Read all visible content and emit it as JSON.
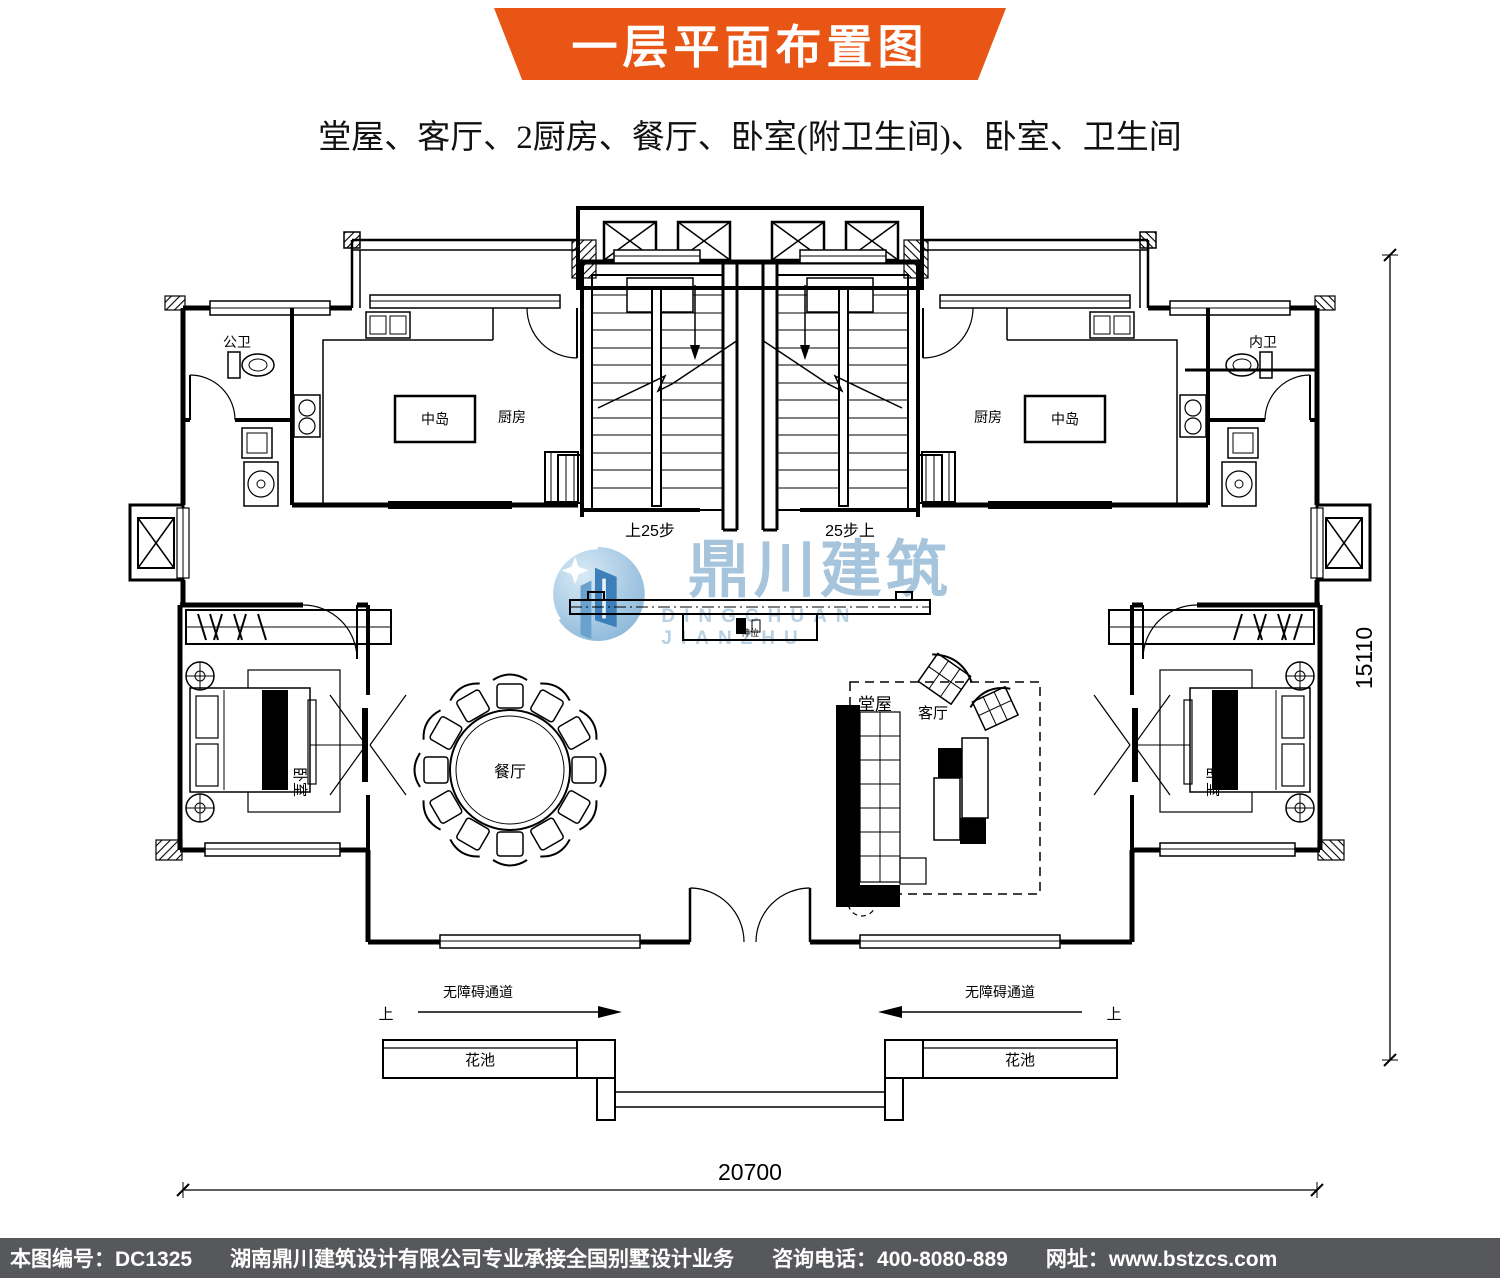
{
  "header": {
    "title": "一层平面布置图",
    "subtitle": "堂屋、客厅、2厨房、餐厅、卧室(附卫生间)、卧室、卫生间",
    "banner_color": "#e95514"
  },
  "plan": {
    "rooms": {
      "public_bath": "公卫",
      "kitchen_left": "厨房",
      "island_left": "中岛",
      "kitchen_right": "厨房",
      "island_right": "中岛",
      "inner_bath": "内卫",
      "bedroom_left": "卧室",
      "bedroom_right": "卧室",
      "dining": "餐厅",
      "hall": "堂屋",
      "living": "客厅",
      "altar": "神位"
    },
    "stairs": {
      "left": "上25步",
      "right": "25步上"
    },
    "annotations": {
      "ramp_left": "无障碍通道",
      "ramp_right": "无障碍通道",
      "up_left": "上",
      "up_right": "上",
      "flowerbed_left": "花池",
      "flowerbed_right": "花池"
    },
    "dimensions": {
      "bottom": "20700",
      "right": "15110"
    }
  },
  "watermark": {
    "zh": "鼎川建筑",
    "en": "DINGCHUAN JIANZHU"
  },
  "footer": {
    "sheet_no": "本图编号：DC1325",
    "company": "湖南鼎川建筑设计有限公司专业承接全国别墅设计业务",
    "phone": "咨询电话：400-8080-889",
    "website": "网址：www.bstzcs.com",
    "bg": "#57585b"
  }
}
